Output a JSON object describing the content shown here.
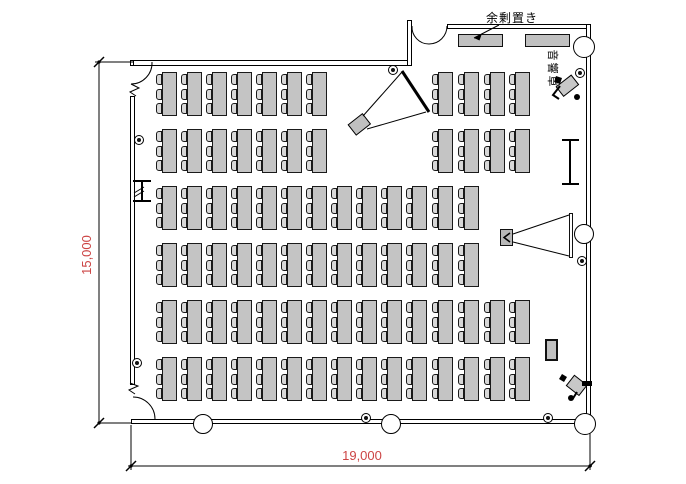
{
  "labels": {
    "surplus_storage": "余剰置き",
    "sound_console": "音響卓"
  },
  "dimensions": {
    "height_label": "15,000",
    "width_label": "19,000"
  },
  "colors": {
    "dim_text": "#cc4444",
    "line": "#000000",
    "desk_fill": "#c4c4c4",
    "chair_fill": "#d8d8d8",
    "furniture_fill": "#c0c0c0"
  },
  "plan": {
    "width": 686,
    "height": 484,
    "walls": [
      {
        "name": "top-wall-left-stub",
        "x": 130,
        "y": 60,
        "w": 4,
        "h": 6
      },
      {
        "name": "top-wall-a",
        "x": 133,
        "y": 60,
        "w": 276,
        "h": 6
      },
      {
        "name": "top-step-wall",
        "x": 407,
        "y": 20,
        "w": 5,
        "h": 46
      },
      {
        "name": "top-wall-b",
        "x": 447,
        "y": 24,
        "w": 144,
        "h": 5
      },
      {
        "name": "right-wall",
        "x": 586,
        "y": 24,
        "w": 5,
        "h": 400
      },
      {
        "name": "bottom-wall",
        "x": 131,
        "y": 419,
        "w": 460,
        "h": 5
      },
      {
        "name": "left-wall",
        "x": 130,
        "y": 96,
        "w": 5,
        "h": 289
      }
    ],
    "columns": [
      {
        "name": "column-top-right",
        "cx": 584,
        "cy": 47,
        "r": 11
      },
      {
        "name": "column-right-mid",
        "cx": 584,
        "cy": 234,
        "r": 10
      },
      {
        "name": "column-bottom-right",
        "cx": 585,
        "cy": 424,
        "r": 11
      },
      {
        "name": "column-bottom-mid",
        "cx": 391,
        "cy": 424,
        "r": 10
      },
      {
        "name": "column-bottom-left",
        "cx": 203,
        "cy": 424,
        "r": 10
      }
    ],
    "fixtures": [
      {
        "cx": 139,
        "cy": 140
      },
      {
        "cx": 137,
        "cy": 363
      },
      {
        "cx": 366,
        "cy": 418
      },
      {
        "cx": 548,
        "cy": 418
      },
      {
        "cx": 582,
        "cy": 261
      },
      {
        "cx": 580,
        "cy": 73
      },
      {
        "cx": 393,
        "cy": 70
      }
    ],
    "furniture": [
      {
        "name": "storage-table-1",
        "x": 458,
        "y": 34,
        "w": 45,
        "h": 13,
        "fill": "#c0c0c0",
        "bw": 1
      },
      {
        "name": "storage-table-2",
        "x": 525,
        "y": 34,
        "w": 45,
        "h": 13,
        "fill": "#c0c0c0",
        "bw": 1
      },
      {
        "name": "side-stand",
        "x": 545,
        "y": 339,
        "w": 13,
        "h": 22,
        "fill": "#c0c0c0",
        "bw": 2
      },
      {
        "name": "projector-right",
        "x": 500,
        "y": 229,
        "w": 13,
        "h": 17,
        "fill": "#b8b8b8",
        "bw": 1
      },
      {
        "name": "projection-screen-right",
        "x": 569,
        "y": 213,
        "w": 4,
        "h": 45,
        "fill": "#ffffff",
        "bw": 1
      }
    ],
    "rotrects": [
      {
        "name": "projector-top",
        "x": 350,
        "y": 118,
        "w": 18,
        "h": 13,
        "rot": -38,
        "cx": 359,
        "cy": 124,
        "fill": "#c0c0c0"
      },
      {
        "name": "sound-operator-desk",
        "x": 558,
        "y": 80,
        "w": 19,
        "h": 12,
        "rot": -38,
        "cx": 567,
        "cy": 86,
        "fill": "#c8c8c8"
      },
      {
        "name": "staff-desk-bottom",
        "x": 569,
        "y": 379,
        "w": 16,
        "h": 13,
        "rot": 38,
        "cx": 577,
        "cy": 385,
        "fill": "#c8c8c8"
      }
    ],
    "desks": {
      "xs": [
        162,
        187,
        212,
        237,
        262,
        287,
        312,
        337,
        362,
        387,
        412,
        438,
        464,
        490,
        515
      ],
      "table_w": 15,
      "table_h": 44,
      "chair_w": 6,
      "chair_h": 11,
      "chair_offsets": [
        2,
        17,
        31
      ],
      "rows": [
        {
          "y": 72,
          "cols": [
            0,
            1,
            2,
            3,
            4,
            5,
            6,
            11,
            12,
            13,
            14
          ]
        },
        {
          "y": 129,
          "cols": [
            0,
            1,
            2,
            3,
            4,
            5,
            6,
            11,
            12,
            13,
            14
          ]
        },
        {
          "y": 186,
          "cols": [
            0,
            1,
            2,
            3,
            4,
            5,
            6,
            7,
            8,
            9,
            10,
            11,
            12
          ]
        },
        {
          "y": 243,
          "cols": [
            0,
            1,
            2,
            3,
            4,
            5,
            6,
            7,
            8,
            9,
            10,
            11,
            12
          ]
        },
        {
          "y": 300,
          "cols": [
            0,
            1,
            2,
            3,
            4,
            5,
            6,
            7,
            8,
            9,
            10,
            11,
            12,
            13,
            14
          ]
        },
        {
          "y": 357,
          "cols": [
            0,
            1,
            2,
            3,
            4,
            5,
            6,
            7,
            8,
            9,
            10,
            11,
            12,
            13,
            14
          ]
        }
      ]
    },
    "paths": [
      {
        "name": "door-top-left-arc",
        "d": "M152,62 A21,21 0 0 1 131,84"
      },
      {
        "name": "door-top-left-leaf",
        "d": "M131,84 L139,88 L130,92 L136,96"
      },
      {
        "name": "door-bottom-left-arc",
        "d": "M133,397 A22,22 0 0 1 155,419"
      },
      {
        "name": "left-wall-break",
        "d": "M130,383 L138,386 L129,390 L135,394"
      },
      {
        "name": "double-door-left-leaf",
        "d": "M412,26 A17,17 0 0 0 429,44"
      },
      {
        "name": "double-door-right-leaf",
        "d": "M447,26 A18,18 0 0 1 429,44"
      },
      {
        "name": "wall-ibeam",
        "d": "M133,181 H151 M142,181 V201 M133,201 H151",
        "w": 2
      },
      {
        "name": "wall-ibeam-hatch",
        "d": "M134,193 L144,187 M134,197 L144,191"
      },
      {
        "name": "screen-stand-right",
        "d": "M562,140 H579 M570,140 V184 M562,184 H579",
        "w": 2
      },
      {
        "name": "projector-top-cone",
        "d": "M363,116 L402,72 M367,129 L426,112"
      },
      {
        "name": "projection-screen-top",
        "d": "M402,71 L429,112",
        "w": 3
      },
      {
        "name": "projector-right-cone",
        "d": "M513,234 L569,215 M513,242 L569,256"
      },
      {
        "name": "projector-right-chevron",
        "d": "M510,233 L504,237.5 L510,242",
        "w": 1.5
      },
      {
        "name": "surplus-leader",
        "d": "M499,25 L474,38"
      },
      {
        "name": "dim-v-line",
        "d": "M99,62 V423"
      },
      {
        "name": "dim-v-ext-top",
        "d": "M95,62 H133"
      },
      {
        "name": "dim-v-ext-bottom",
        "d": "M99,423 H131"
      },
      {
        "name": "dim-h-line",
        "d": "M128,466 H592"
      },
      {
        "name": "dim-h-ext-left",
        "d": "M131,425 V470"
      },
      {
        "name": "dim-h-ext-right",
        "d": "M590,433 V470"
      },
      {
        "name": "dim-ticks",
        "d": "M94,67 L104,57 M94,428 L104,418 M126,471 L136,461 M585,471 L595,461",
        "w": 1.5
      },
      {
        "name": "person-sound-op",
        "d": "M560,86 L553,95 L559,99",
        "w": 2
      },
      {
        "name": "person-bottom",
        "d": "M577,392 L572,400",
        "w": 2
      }
    ],
    "filled": [
      {
        "name": "surplus-leader-arrow",
        "d": "M474,38 L482,33.5 L479.5,40.5 Z"
      },
      {
        "name": "person-sound-op-head",
        "d": "M577,97 m-3,0 a3,3 0 1 0 6,0 a3,3 0 1 0 -6,0"
      },
      {
        "name": "person-sound-op-shoulder",
        "d": "M556,76 l6,2 -2,6 -6,-2 Z"
      },
      {
        "name": "person-bottom-head",
        "d": "M571,398 m-3,0 a3,3 0 1 0 6,0 a3,3 0 1 0 -6,0"
      },
      {
        "name": "person-bottom-arm",
        "d": "M582,381 h10 v5 h-10 Z"
      },
      {
        "name": "person-bottom-shoulder",
        "d": "M562,374 l5,3 -3,5 -5,-3 Z"
      }
    ],
    "dots": [
      {
        "cx": 99,
        "cy": 62
      },
      {
        "cx": 99,
        "cy": 423
      },
      {
        "cx": 131,
        "cy": 466
      },
      {
        "cx": 590,
        "cy": 466
      }
    ]
  }
}
